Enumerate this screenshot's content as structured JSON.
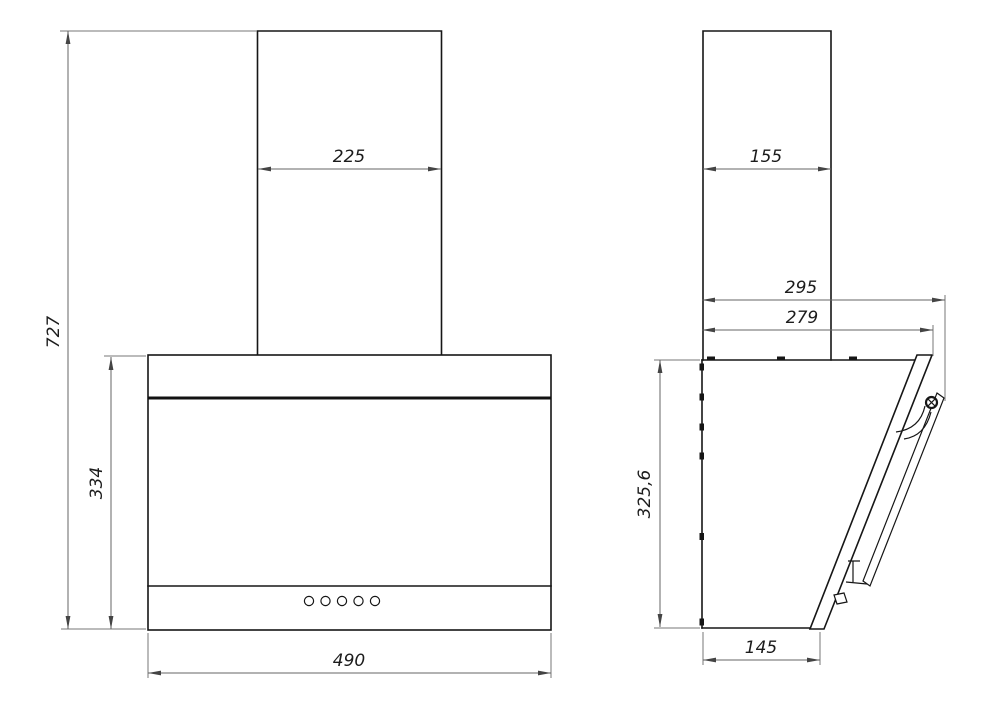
{
  "drawing": {
    "type": "technical-dimension-drawing",
    "subject": "wall-mounted angled cooker hood, front view and side view",
    "units": "mm",
    "front_view": {
      "dims": {
        "total_height": "727",
        "chimney_width": "225",
        "body_height": "334",
        "body_width": "490"
      },
      "buttons_count": 5
    },
    "side_view": {
      "dims": {
        "chimney_depth": "155",
        "overall_depth": "295",
        "panel_depth": "279",
        "body_height": "325,6",
        "bottom_depth": "145"
      }
    },
    "colors": {
      "background": "#ffffff",
      "object_line": "#161616",
      "dimension_line": "#666666",
      "text": "#1c1c1c"
    }
  }
}
